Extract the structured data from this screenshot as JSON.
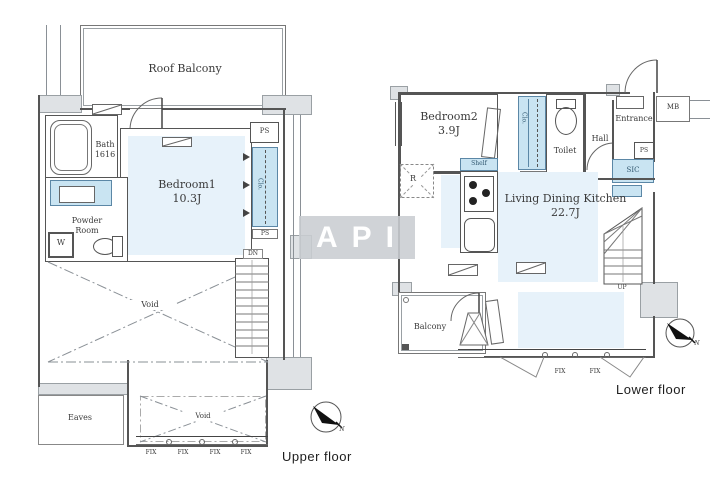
{
  "watermark": {
    "text": "API"
  },
  "compass": {
    "north": "N"
  },
  "colors": {
    "room": "#e7f2fa",
    "closet": "#c9e4f2",
    "closetbd": "#5b87a6",
    "wallfill": "#dfe2e5",
    "line": "#555555",
    "label": "#3a3a3a",
    "wmbg": "rgba(201,205,209,.88)",
    "wmtx": "#ffffff"
  },
  "upper": {
    "caption": "Upper floor",
    "roof_balcony": "Roof Balcony",
    "bath_line1": "Bath",
    "bath_line2": "1616",
    "laundry_pipe": "Laundry pipe",
    "bedroom_name": "Bedroom1",
    "bedroom_size": "10.3J",
    "ps_top": "PS",
    "clo": "Clo.",
    "ps_side": "PS",
    "powder_line1": "Powder",
    "powder_line2": "Room",
    "washer": "W",
    "dn": "DN",
    "void_main": "Void",
    "void_lower": "Void",
    "eaves": "Eaves",
    "fix": [
      "FIX",
      "FIX",
      "FIX",
      "FIX"
    ]
  },
  "lower": {
    "caption": "Lower floor",
    "bedroom_name": "Bedroom2",
    "bedroom_size": "3.9J",
    "clo": "Clo.",
    "ps_clo": "PS",
    "toilet": "Toilet",
    "hall": "Hall",
    "entrance": "Entrance",
    "mb": "MB",
    "ps_entry": "PS",
    "sic": "SIC",
    "r": "R",
    "shelf": "Shelf",
    "ldk_name": "Living Dining Kitchen",
    "ldk_size": "22.7J",
    "up": "UP",
    "balcony": "Balcony",
    "fix": [
      "FIX",
      "FIX"
    ]
  }
}
